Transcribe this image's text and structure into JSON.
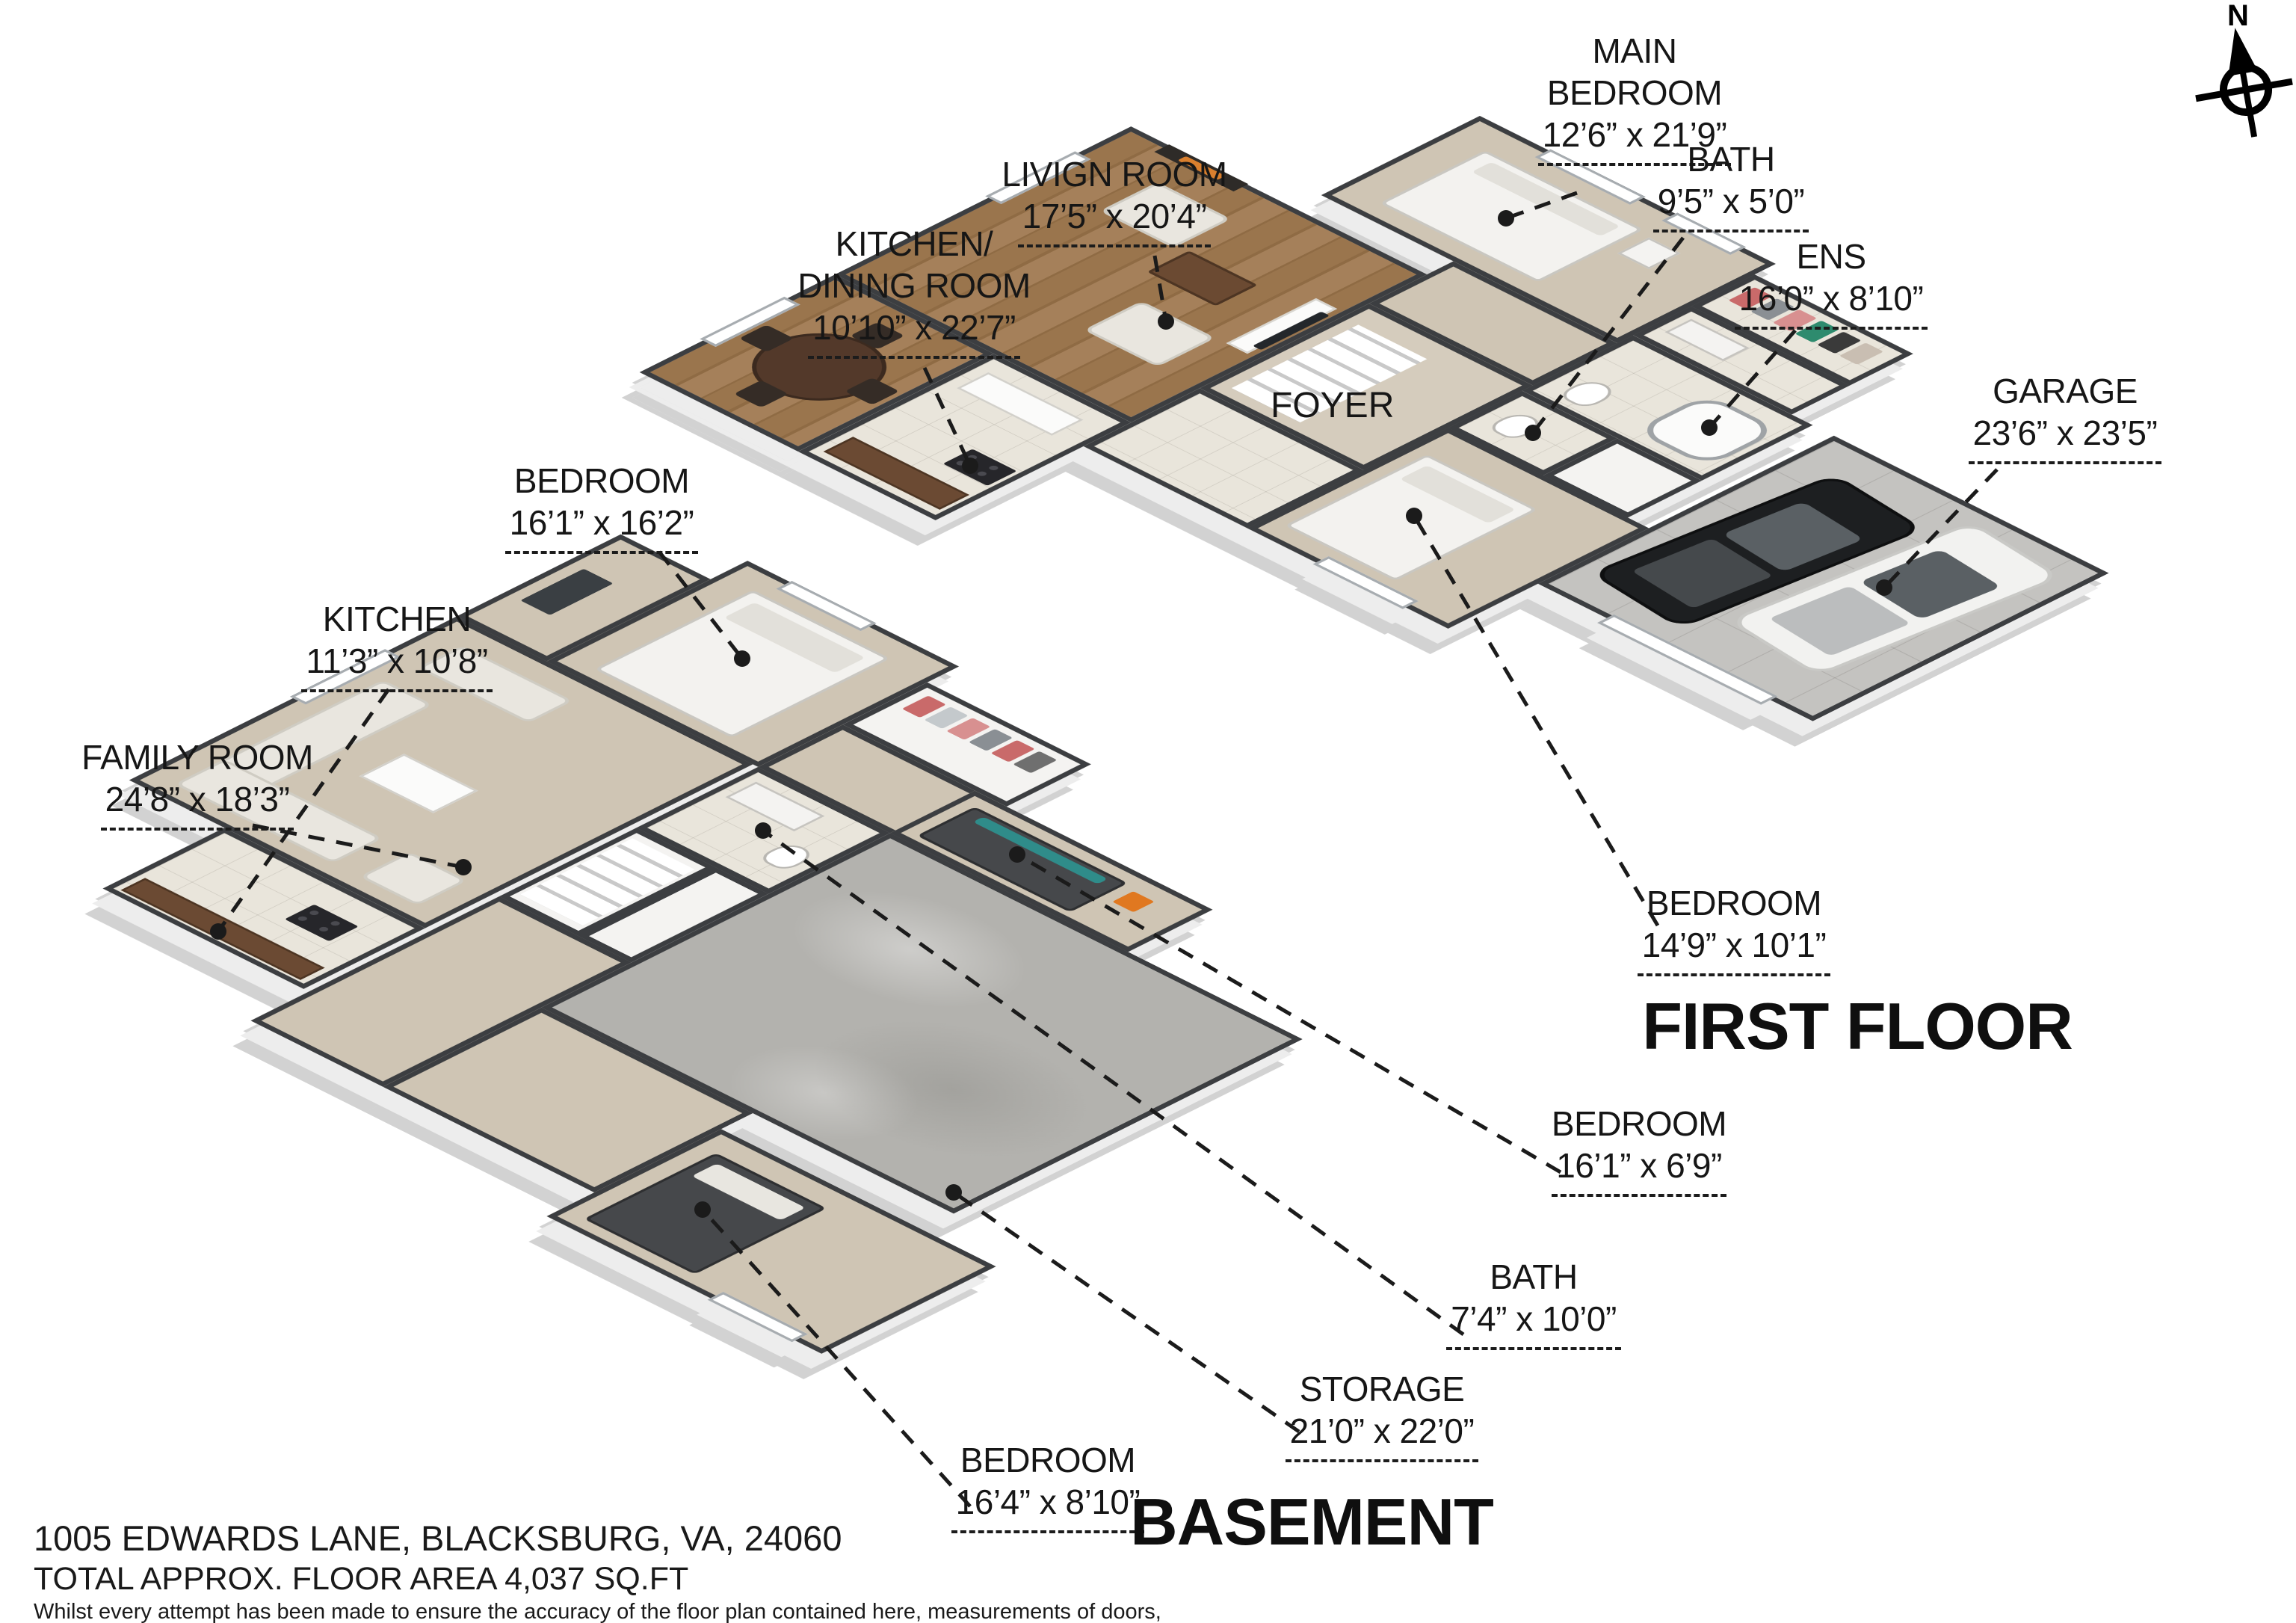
{
  "compass": {
    "north_label": "N"
  },
  "first_floor": {
    "title": "FIRST FLOOR",
    "labels": {
      "main_bedroom": {
        "name": "MAIN BEDROOM",
        "dims": "12’6” x 21’9”"
      },
      "bath": {
        "name": "BATH",
        "dims": "9’5” x 5’0”"
      },
      "ens": {
        "name": "ENS",
        "dims": "16’0” x 8’10”"
      },
      "garage": {
        "name": "GARAGE",
        "dims": "23’6” x 23’5”"
      },
      "living_room": {
        "name": "LIVIGN ROOM",
        "dims": "17’5” x 20’4”"
      },
      "kitchen_dining": {
        "name_line1": "KITCHEN/",
        "name_line2": "DINING ROOM",
        "dims": "10’10” x 22’7”"
      },
      "foyer": {
        "name": "FOYER"
      },
      "bedroom_south": {
        "name": "BEDROOM",
        "dims": "14’9” x 10’1”"
      }
    }
  },
  "basement": {
    "title": "BASEMENT",
    "labels": {
      "bedroom_north": {
        "name": "BEDROOM",
        "dims": "16’1” x 16’2”"
      },
      "kitchen": {
        "name": "KITCHEN",
        "dims": "11’3” x 10’8”"
      },
      "family_room": {
        "name": "FAMILY ROOM",
        "dims": "24’8” x 18’3”"
      },
      "bedroom_east": {
        "name": "BEDROOM",
        "dims": "16’1” x 6’9”"
      },
      "bath": {
        "name": "BATH",
        "dims": "7’4” x 10’0”"
      },
      "storage": {
        "name": "STORAGE",
        "dims": "21’0” x 22’0”"
      },
      "bedroom_south": {
        "name": "BEDROOM",
        "dims": "16’4” x 8’10”"
      }
    }
  },
  "footer": {
    "address": "1005 EDWARDS LANE, BLACKSBURG, VA, 24060",
    "total_area": "TOTAL APPROX. FLOOR AREA 4,037 SQ.FT",
    "disclaimer": [
      "Whilst every attempt has been made to ensure the accuracy of the floor plan contained here, measurements of doors,",
      "windows, rooms and any other items are approximate and no responsibility is taken for any error, omission, or misstatement.",
      "This plan is for illustrative purposes only and should be used as such by any prospective purchaser."
    ]
  },
  "colors": {
    "wall": "#3c3e41",
    "carpet": "#cfc5b4",
    "wood_floor": "#9a754d",
    "concrete": "#b3b2ae",
    "accent_teal": "#2f8c8a",
    "leader": "#1b1b1b"
  }
}
